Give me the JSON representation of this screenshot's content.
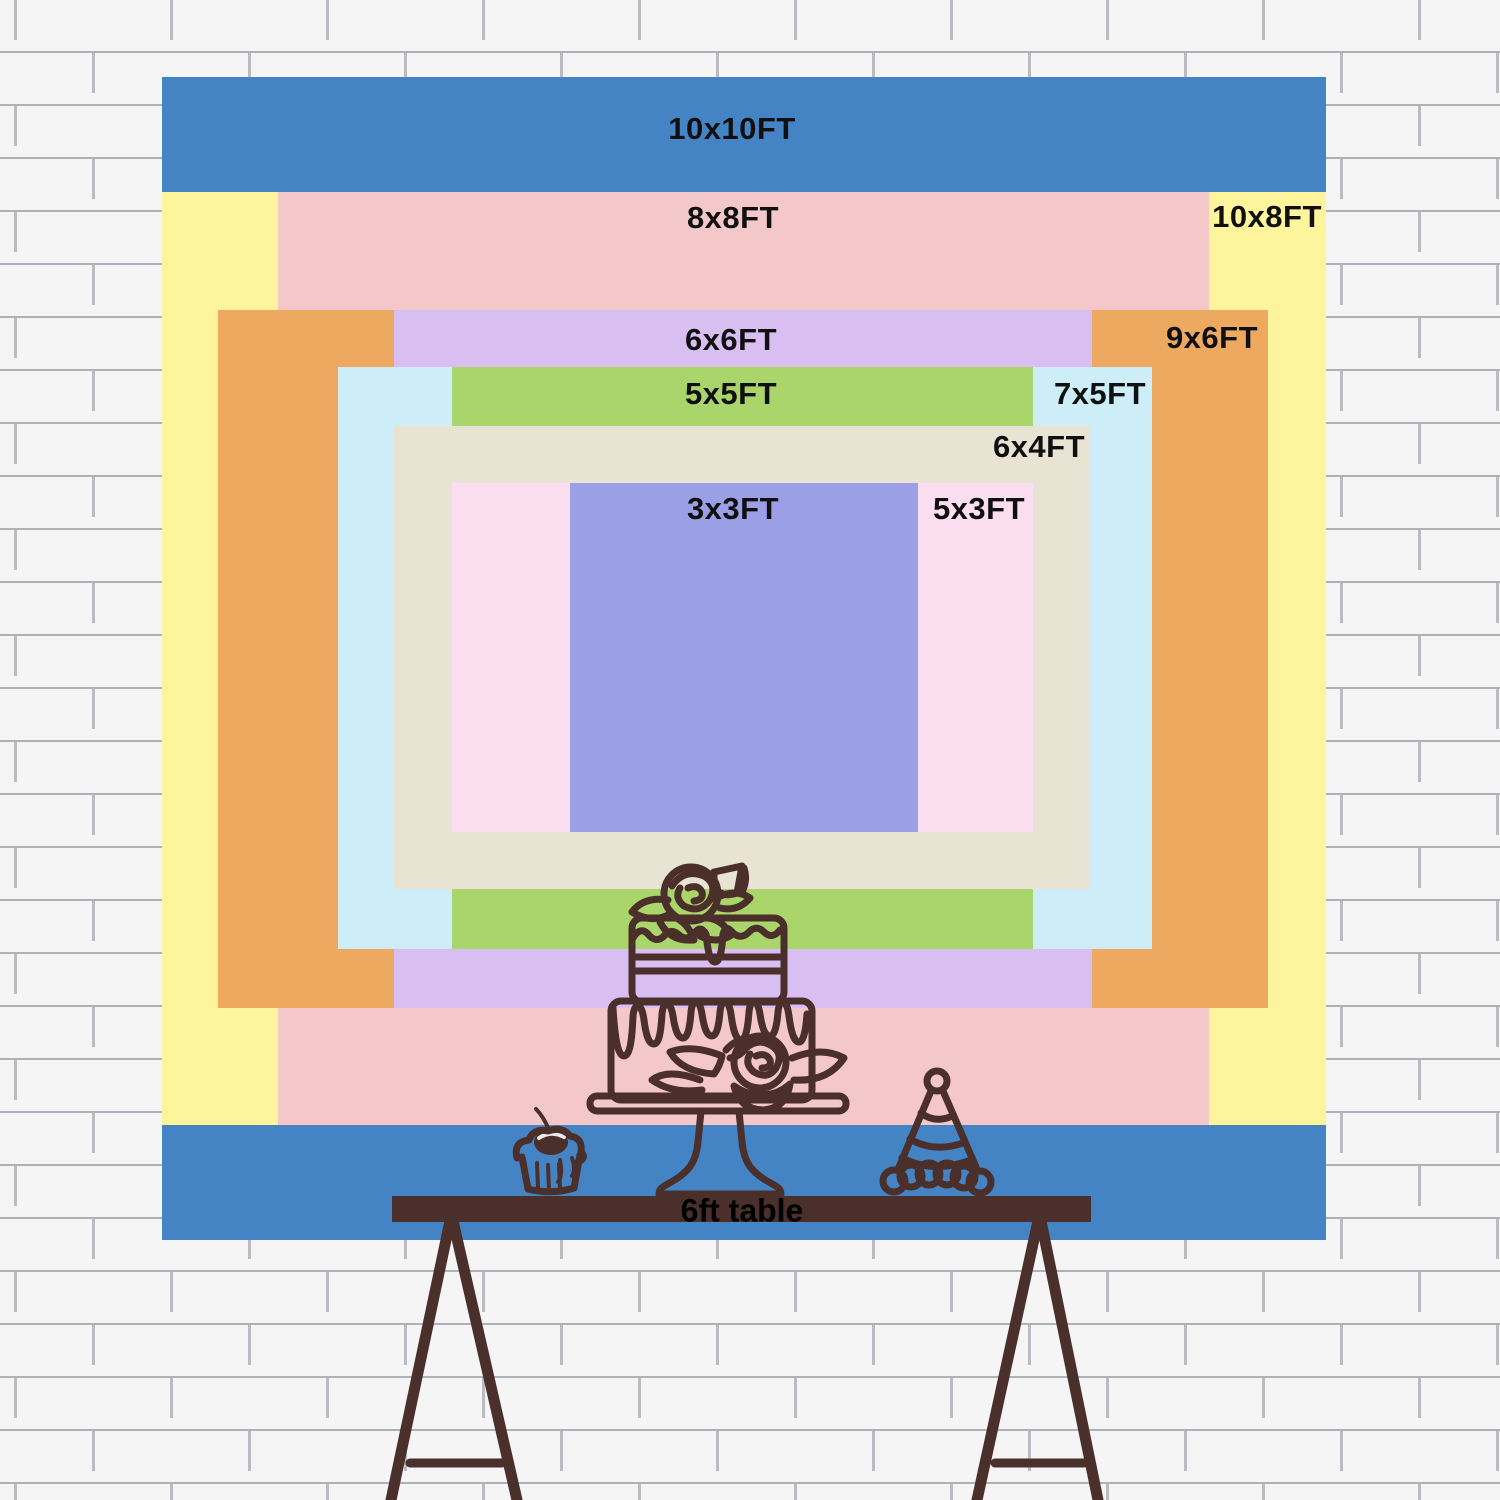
{
  "title": "Backdrop size comparison chart",
  "palette": {
    "blue_10x10": "#4484c4",
    "yellow_10x8": "#fdf49c",
    "pink_8x8": "#f4c8c9",
    "orange_9x6": "#eda960",
    "lavender_6x6": "#d9bef1",
    "light_blue_7x5": "#cdedf8",
    "green_5x5": "#aad56a",
    "beige_6x4": "#e9e3d4",
    "light_pink_5x3": "#fbdff0",
    "periwinkle_3x3": "#9b9fe6",
    "line_and_table_brown": "#4a2f2b",
    "label_text": "#101010",
    "wall_white": "#f6f5f6"
  },
  "sizes": [
    {
      "id": "10x10",
      "label": "10x10FT",
      "width_ft": 10,
      "height_ft": 10,
      "color": "#4484c4"
    },
    {
      "id": "10x8",
      "label": "10x8FT",
      "width_ft": 10,
      "height_ft": 8,
      "color": "#fdf49c"
    },
    {
      "id": "8x8",
      "label": "8x8FT",
      "width_ft": 8,
      "height_ft": 8,
      "color": "#f4c8c9"
    },
    {
      "id": "9x6",
      "label": "9x6FT",
      "width_ft": 9,
      "height_ft": 6,
      "color": "#eda960"
    },
    {
      "id": "6x6",
      "label": "6x6FT",
      "width_ft": 6,
      "height_ft": 6,
      "color": "#d9bef1"
    },
    {
      "id": "7x5",
      "label": "7x5FT",
      "width_ft": 7,
      "height_ft": 5,
      "color": "#cdedf8"
    },
    {
      "id": "5x5",
      "label": "5x5FT",
      "width_ft": 5,
      "height_ft": 5,
      "color": "#aad56a"
    },
    {
      "id": "6x4",
      "label": "6x4FT",
      "width_ft": 6,
      "height_ft": 4,
      "color": "#e9e3d4"
    },
    {
      "id": "5x3",
      "label": "5x3FT",
      "width_ft": 5,
      "height_ft": 3,
      "color": "#fbdff0"
    },
    {
      "id": "3x3",
      "label": "3x3FT",
      "width_ft": 3,
      "height_ft": 3,
      "color": "#9b9fe6"
    }
  ],
  "table": {
    "label": "6ft table"
  },
  "illustrations": [
    "two-tier-cake-on-stand",
    "cupcake-with-cherry",
    "party-hat",
    "trestle-table"
  ]
}
